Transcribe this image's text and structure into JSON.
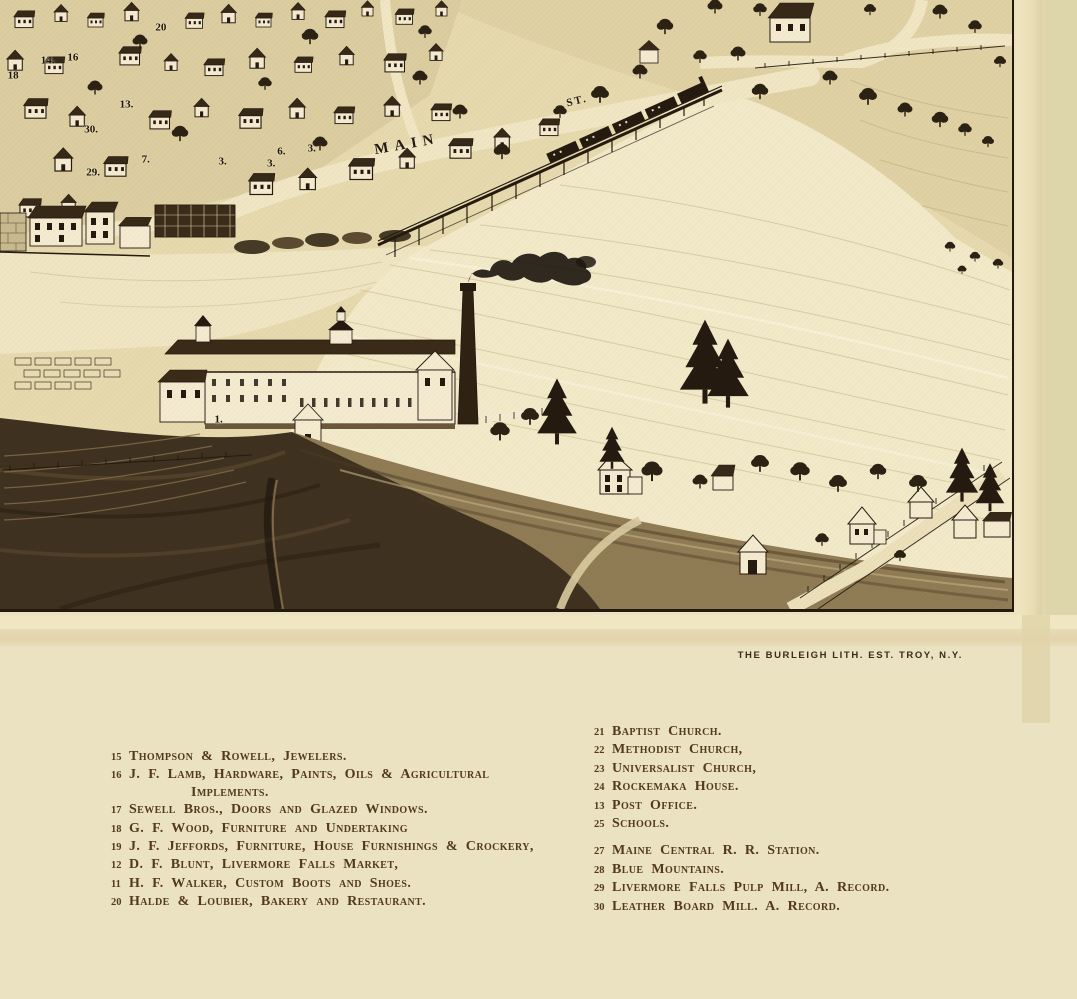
{
  "imprint": "THE BURLEIGH LITH. EST. TROY, N.Y.",
  "map": {
    "street_labels": {
      "main": "MAIN",
      "st": "ST."
    },
    "markers": [
      {
        "label": "20",
        "x": 15.9,
        "y": 4.6
      },
      {
        "label": "14.",
        "x": 4.7,
        "y": 10.0
      },
      {
        "label": "16",
        "x": 7.2,
        "y": 9.5
      },
      {
        "label": "18",
        "x": 1.3,
        "y": 12.4
      },
      {
        "label": "13.",
        "x": 12.5,
        "y": 17.3
      },
      {
        "label": "30.",
        "x": 9.0,
        "y": 21.4
      },
      {
        "label": "29.",
        "x": 9.2,
        "y": 28.4
      },
      {
        "label": "7.",
        "x": 14.4,
        "y": 26.3
      },
      {
        "label": "3.",
        "x": 22.0,
        "y": 26.6
      },
      {
        "label": "6.",
        "x": 27.8,
        "y": 25.0
      },
      {
        "label": "3.",
        "x": 26.8,
        "y": 27.0
      },
      {
        "label": "3.",
        "x": 30.8,
        "y": 24.5
      },
      {
        "label": "1.",
        "x": 21.6,
        "y": 69.0
      }
    ]
  },
  "legend": {
    "left": [
      {
        "num": "15",
        "text": "Thompson & Rowell, Jewelers."
      },
      {
        "num": "16",
        "text": "J. F. Lamb, Hardware, Paints, Oils & Agricultural",
        "text2": "Implements."
      },
      {
        "num": "17",
        "text": "Sewell Bros., Doors and Glazed Windows."
      },
      {
        "num": "18",
        "text": "G. F. Wood, Furniture and Undertaking"
      },
      {
        "num": "19",
        "text": "J. F. Jeffords, Furniture, House Furnishings & Crockery,"
      },
      {
        "num": "12",
        "text": "D. F. Blunt, Livermore Falls Market,"
      },
      {
        "num": "11",
        "text": "H. F. Walker, Custom Boots and Shoes."
      },
      {
        "num": "20",
        "text": "Halde & Loubier, Bakery and Restaurant."
      }
    ],
    "right": [
      {
        "num": "21",
        "text": "Baptist Church."
      },
      {
        "num": "22",
        "text": "Methodist Church,"
      },
      {
        "num": "23",
        "text": "Universalist Church,"
      },
      {
        "num": "24",
        "text": "Rockemaka House."
      },
      {
        "num": "13",
        "text": "Post Office."
      },
      {
        "num": "25",
        "text": "Schools."
      },
      {
        "num": "27",
        "text": "Maine Central R. R. Station.",
        "gap": true
      },
      {
        "num": "28",
        "text": "Blue Mountains."
      },
      {
        "num": "29",
        "text": "Livermore Falls Pulp Mill, A. Record."
      },
      {
        "num": "30",
        "text": "Leather Board Mill. A. Record."
      }
    ]
  },
  "colors": {
    "paper_khaki": "#eae2c1",
    "margin_cream": "#ece0ba",
    "paper_edge": "#ded6ab",
    "ink": "#241a10",
    "legend_text": "#53391e",
    "water_light": "#f2e9c9",
    "illustration_base": "#e6d9ae"
  }
}
